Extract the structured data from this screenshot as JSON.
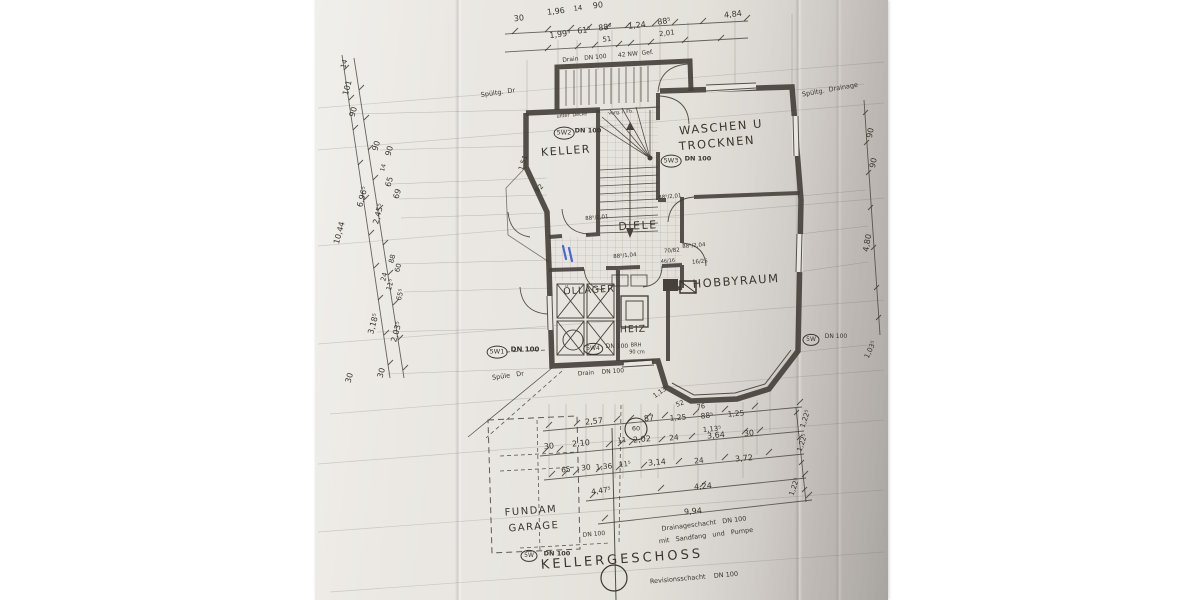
{
  "colors": {
    "paper": "#e9e6e1",
    "paper_dark": "#b3afaa",
    "ink": "#3a362f",
    "wall": "#46413c",
    "faint": "#6e6a64",
    "blue_mark": "#2f54cc"
  },
  "labels": {
    "title": [
      {
        "t": "KELLERGESCHOSS",
        "x": 622,
        "y": 560,
        "r": -4,
        "s": 13,
        "ls": 3
      }
    ],
    "rooms": [
      {
        "t": "KELLER",
        "x": 566,
        "y": 151,
        "r": -4,
        "s": 11,
        "ls": 1.5
      },
      {
        "t": "WASCHEN U",
        "x": 721,
        "y": 127,
        "r": -5,
        "s": 11.5,
        "ls": 1.5
      },
      {
        "t": "TROCKNEN",
        "x": 717,
        "y": 143,
        "r": -5,
        "s": 11.5,
        "ls": 1.5
      },
      {
        "t": "DIELE",
        "x": 638,
        "y": 226,
        "r": -3,
        "s": 11,
        "ls": 1.5
      },
      {
        "t": "HOBBYRAUM",
        "x": 736,
        "y": 281,
        "r": -4,
        "s": 11.5,
        "ls": 1.5
      },
      {
        "t": "ÖLLAGER",
        "x": 589,
        "y": 291,
        "r": -3,
        "s": 9.5,
        "ls": 1
      },
      {
        "t": "HEIZ",
        "x": 633,
        "y": 330,
        "r": -2,
        "s": 9.5,
        "ls": 1
      },
      {
        "t": "FUNDAM",
        "x": 531,
        "y": 512,
        "r": -4,
        "s": 10,
        "ls": 1.5
      },
      {
        "t": "GARAGE",
        "x": 534,
        "y": 528,
        "r": -4,
        "s": 10,
        "ls": 1.5
      }
    ],
    "fixtures": [
      {
        "t": "5W1",
        "x": 497,
        "y": 352,
        "cls": "circ",
        "s": 6.5
      },
      {
        "t": "DN 100",
        "x": 525,
        "y": 350,
        "s": 7,
        "b": 1
      },
      {
        "t": "5W2",
        "x": 564,
        "y": 133,
        "cls": "circ",
        "s": 6.5
      },
      {
        "t": "DN 100",
        "x": 588,
        "y": 131,
        "s": 6.5,
        "b": 1
      },
      {
        "t": "5W3",
        "x": 671,
        "y": 161,
        "cls": "circ",
        "s": 6.5
      },
      {
        "t": "DN 100",
        "x": 698,
        "y": 159,
        "s": 6.5,
        "b": 1
      },
      {
        "t": "5W4",
        "x": 593,
        "y": 349,
        "cls": "circ",
        "s": 6
      },
      {
        "t": "DN 100",
        "x": 617,
        "y": 347,
        "s": 6
      },
      {
        "t": "5W",
        "x": 811,
        "y": 340,
        "cls": "circ",
        "s": 6
      },
      {
        "t": "DN 100",
        "x": 836,
        "y": 337,
        "s": 6
      },
      {
        "t": "5W",
        "x": 529,
        "y": 556,
        "cls": "circ",
        "s": 6
      },
      {
        "t": "DN 100",
        "x": 557,
        "y": 554,
        "s": 6.5,
        "b": 1
      },
      {
        "t": "60",
        "x": 636,
        "y": 429,
        "s": 6.5
      }
    ],
    "dims_top": [
      {
        "t": "30",
        "x": 519,
        "y": 19,
        "r": -7
      },
      {
        "t": "1,96",
        "x": 556,
        "y": 12,
        "r": -7
      },
      {
        "t": "14",
        "x": 578,
        "y": 9,
        "r": -7,
        "s": 7
      },
      {
        "t": "90",
        "x": 598,
        "y": 6,
        "r": -7
      },
      {
        "t": "4,84",
        "x": 733,
        "y": 15,
        "r": -7
      },
      {
        "t": "1,99⁵",
        "x": 560,
        "y": 35,
        "r": -7
      },
      {
        "t": "61⁵",
        "x": 584,
        "y": 31,
        "r": -7
      },
      {
        "t": "88⁶",
        "x": 605,
        "y": 28,
        "r": -7
      },
      {
        "t": "51",
        "x": 607,
        "y": 40,
        "r": -7,
        "s": 7
      },
      {
        "t": "1,24",
        "x": 637,
        "y": 26,
        "r": -7
      },
      {
        "t": "88⁵",
        "x": 664,
        "y": 22,
        "r": -7
      },
      {
        "t": "2,01",
        "x": 667,
        "y": 34,
        "r": -7,
        "s": 7
      }
    ],
    "dims_left": [
      {
        "t": "14",
        "x": 345,
        "y": 64,
        "r": -75,
        "s": 7
      },
      {
        "t": "101",
        "x": 348,
        "y": 88,
        "r": -75
      },
      {
        "t": "90",
        "x": 354,
        "y": 112,
        "r": -75
      },
      {
        "t": "90",
        "x": 377,
        "y": 146,
        "r": -75
      },
      {
        "t": "90",
        "x": 390,
        "y": 151,
        "r": -75
      },
      {
        "t": "14",
        "x": 384,
        "y": 168,
        "r": -75,
        "s": 6
      },
      {
        "t": "65",
        "x": 390,
        "y": 182,
        "r": -75
      },
      {
        "t": "69",
        "x": 398,
        "y": 194,
        "r": -75
      },
      {
        "t": "6,96⁵",
        "x": 363,
        "y": 197,
        "r": -75
      },
      {
        "t": "2,45⁵",
        "x": 379,
        "y": 214,
        "r": -75
      },
      {
        "t": "10,44",
        "x": 340,
        "y": 233,
        "r": -75
      },
      {
        "t": "88",
        "x": 393,
        "y": 259,
        "r": -75,
        "s": 7
      },
      {
        "t": "60",
        "x": 399,
        "y": 268,
        "r": -75,
        "s": 7
      },
      {
        "t": "24",
        "x": 385,
        "y": 277,
        "r": -75,
        "s": 7
      },
      {
        "t": "11⁵",
        "x": 391,
        "y": 285,
        "r": -75,
        "s": 7
      },
      {
        "t": "65⁵",
        "x": 401,
        "y": 295,
        "r": -75,
        "s": 7
      },
      {
        "t": "3,18⁵",
        "x": 374,
        "y": 324,
        "r": -75
      },
      {
        "t": "2,03⁵",
        "x": 397,
        "y": 332,
        "r": -75
      },
      {
        "t": "30",
        "x": 382,
        "y": 373,
        "r": -75
      },
      {
        "t": "30",
        "x": 350,
        "y": 378,
        "r": -75
      }
    ],
    "dims_right": [
      {
        "t": "90",
        "x": 871,
        "y": 133,
        "r": -78
      },
      {
        "t": "90",
        "x": 874,
        "y": 163,
        "r": -78
      },
      {
        "t": "4,80",
        "x": 868,
        "y": 243,
        "r": -80
      },
      {
        "t": "1,03⁵",
        "x": 871,
        "y": 350,
        "r": -65,
        "s": 7
      },
      {
        "t": "1,22⁵",
        "x": 806,
        "y": 419,
        "r": -72,
        "s": 7
      },
      {
        "t": "1,22⁵",
        "x": 803,
        "y": 443,
        "r": -72,
        "s": 7
      },
      {
        "t": "1,22⁵",
        "x": 795,
        "y": 487,
        "r": -72,
        "s": 7
      }
    ],
    "dims_bottom": [
      {
        "t": "2,57",
        "x": 594,
        "y": 422,
        "r": -5
      },
      {
        "t": "87",
        "x": 649,
        "y": 419,
        "r": -5
      },
      {
        "t": "1,25",
        "x": 678,
        "y": 418,
        "r": -5,
        "s": 7.5
      },
      {
        "t": "88⁵",
        "x": 707,
        "y": 416,
        "r": -5,
        "s": 7.5
      },
      {
        "t": "1,25",
        "x": 736,
        "y": 414,
        "r": -5,
        "s": 7.5
      },
      {
        "t": "1,13⁵",
        "x": 712,
        "y": 430,
        "r": -5,
        "s": 7
      },
      {
        "t": "1,13⁵",
        "x": 661,
        "y": 392,
        "r": -35,
        "s": 6.5
      },
      {
        "t": "52",
        "x": 680,
        "y": 404,
        "r": -22,
        "s": 6.5
      },
      {
        "t": "76",
        "x": 701,
        "y": 407,
        "r": -10,
        "s": 6.5
      },
      {
        "t": "30",
        "x": 549,
        "y": 447,
        "r": -5
      },
      {
        "t": "2,10",
        "x": 581,
        "y": 444,
        "r": -5
      },
      {
        "t": "11",
        "x": 622,
        "y": 441,
        "r": -5,
        "s": 7
      },
      {
        "t": "2,02",
        "x": 642,
        "y": 440,
        "r": -5
      },
      {
        "t": "24",
        "x": 674,
        "y": 438,
        "r": -5,
        "s": 7.5
      },
      {
        "t": "3,64",
        "x": 716,
        "y": 436,
        "r": -5
      },
      {
        "t": "30",
        "x": 749,
        "y": 434,
        "r": -5
      },
      {
        "t": "65",
        "x": 566,
        "y": 470,
        "r": -5,
        "s": 7.5
      },
      {
        "t": "30",
        "x": 586,
        "y": 468,
        "r": -5,
        "s": 7.5
      },
      {
        "t": "1,36",
        "x": 604,
        "y": 467,
        "r": -5,
        "s": 7.5
      },
      {
        "t": "11⁵",
        "x": 625,
        "y": 465,
        "r": -5,
        "s": 7
      },
      {
        "t": "3,14",
        "x": 657,
        "y": 463,
        "r": -5
      },
      {
        "t": "24",
        "x": 699,
        "y": 461,
        "r": -5,
        "s": 7.5
      },
      {
        "t": "3,72",
        "x": 744,
        "y": 459,
        "r": -5
      },
      {
        "t": "4,47⁵",
        "x": 601,
        "y": 491,
        "r": -8,
        "s": 7.5
      },
      {
        "t": "4,24",
        "x": 703,
        "y": 487,
        "r": -5
      },
      {
        "t": "9,94",
        "x": 693,
        "y": 512,
        "r": -5
      }
    ],
    "dims_plan": [
      {
        "t": "92",
        "x": 540,
        "y": 189,
        "r": -50,
        "s": 7
      },
      {
        "t": "1,51",
        "x": 524,
        "y": 163,
        "r": -72,
        "s": 7
      },
      {
        "t": "88⁵/2,01",
        "x": 670,
        "y": 198,
        "r": -5,
        "s": 5.5
      },
      {
        "t": "88⁵/2,01",
        "x": 597,
        "y": 219,
        "r": -5,
        "s": 5.5
      },
      {
        "t": "88⁵/2,04",
        "x": 694,
        "y": 247,
        "r": -5,
        "s": 5.5
      },
      {
        "t": "88⁵/1,04",
        "x": 625,
        "y": 257,
        "r": -5,
        "s": 5.5
      },
      {
        "t": "70/82",
        "x": 672,
        "y": 252,
        "r": -5,
        "s": 5.5
      },
      {
        "t": "46/16",
        "x": 668,
        "y": 262,
        "r": -5,
        "s": 5
      },
      {
        "t": "16/25",
        "x": 700,
        "y": 263,
        "r": -5,
        "s": 5.5
      }
    ],
    "notes": [
      {
        "t": "Drain   DN 100      42 NW  Gef.",
        "x": 608,
        "y": 57,
        "r": -5,
        "s": 6
      },
      {
        "t": "Spültg.  Dr",
        "x": 498,
        "y": 93,
        "r": -8,
        "s": 6.5
      },
      {
        "t": "Spültg.  Drainage",
        "x": 830,
        "y": 90,
        "r": -10,
        "s": 6.5
      },
      {
        "t": "unter  Decke",
        "x": 572,
        "y": 116,
        "r": -5,
        "s": 4.8
      },
      {
        "t": "vorg. i. Fb.",
        "x": 621,
        "y": 113,
        "r": -5,
        "s": 4.8
      },
      {
        "t": "Spüle   Dr",
        "x": 508,
        "y": 376,
        "r": -8,
        "s": 6.5
      },
      {
        "t": "Drain    DN 100",
        "x": 601,
        "y": 373,
        "r": -4,
        "s": 6
      },
      {
        "t": "BRH",
        "x": 636,
        "y": 346,
        "s": 5
      },
      {
        "t": "90 cm",
        "x": 637,
        "y": 353,
        "s": 5
      },
      {
        "t": "DN 100",
        "x": 594,
        "y": 535,
        "r": -5,
        "s": 6
      },
      {
        "t": "Drainageschacht   DN 100",
        "x": 704,
        "y": 524,
        "r": -7,
        "s": 6.5
      },
      {
        "t": "mit   Sandfang   und   Pumpe",
        "x": 706,
        "y": 536,
        "r": -7,
        "s": 6.5
      },
      {
        "t": "Revisionsschacht    DN 100",
        "x": 694,
        "y": 578,
        "r": -5,
        "s": 6.5
      }
    ]
  }
}
